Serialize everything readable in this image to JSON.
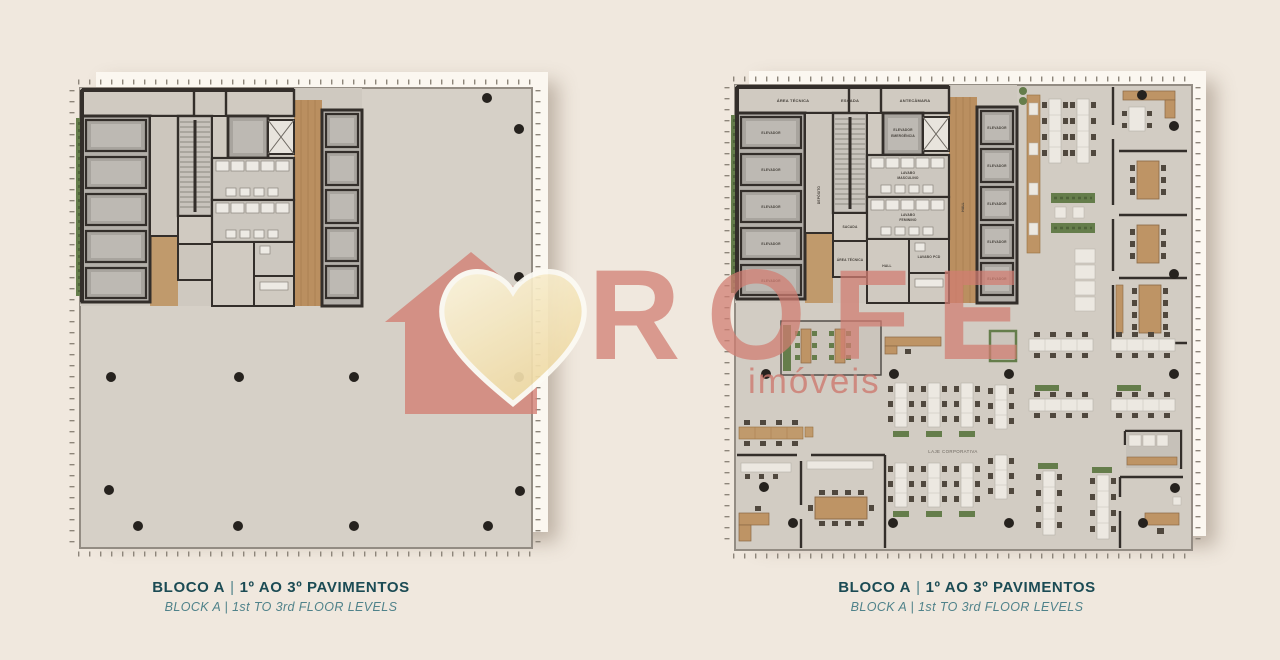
{
  "page": {
    "background": "#F0E8DE"
  },
  "watermark": {
    "brand": "ROFE",
    "tagline": "imóveis",
    "rose": "#D17D72",
    "heart_cream": "#F2E0A8"
  },
  "captions": {
    "title_block": "BLOCO A",
    "title_sep": "|",
    "title_levels": "1º AO 3º PAVIMENTOS",
    "subtitle": "BLOCK A  |  1st TO 3rd FLOOR LEVELS"
  },
  "room_labels": {
    "area_tecnica": "ÁREA TÉCNICA",
    "escada": "ESCADA",
    "antecamara": "ANTECÂMARA",
    "elevador": "ELEVADOR",
    "emergencia": "EMERGÊNCIA",
    "deposito": "DEPÓSITO",
    "sacada": "SACADA",
    "lavabo": "LAVABO",
    "masculino": "MASCULINO",
    "feminino": "FEMININO",
    "lavabo_pcd": "LAVABO PCD",
    "hall": "HALL",
    "laje_corporativa": "LAJE CORPORATIVA"
  },
  "colors": {
    "floor": "#D5CFC6",
    "wall": "#332E2A",
    "wood": "#BE9465",
    "greenery": "#657D4B",
    "desk_white": "#ECE8E1",
    "chair_dark": "#50483E",
    "column_dot": "#26221E",
    "caption_teal": "#1B4B54",
    "caption_teal_light": "#4F828A"
  }
}
